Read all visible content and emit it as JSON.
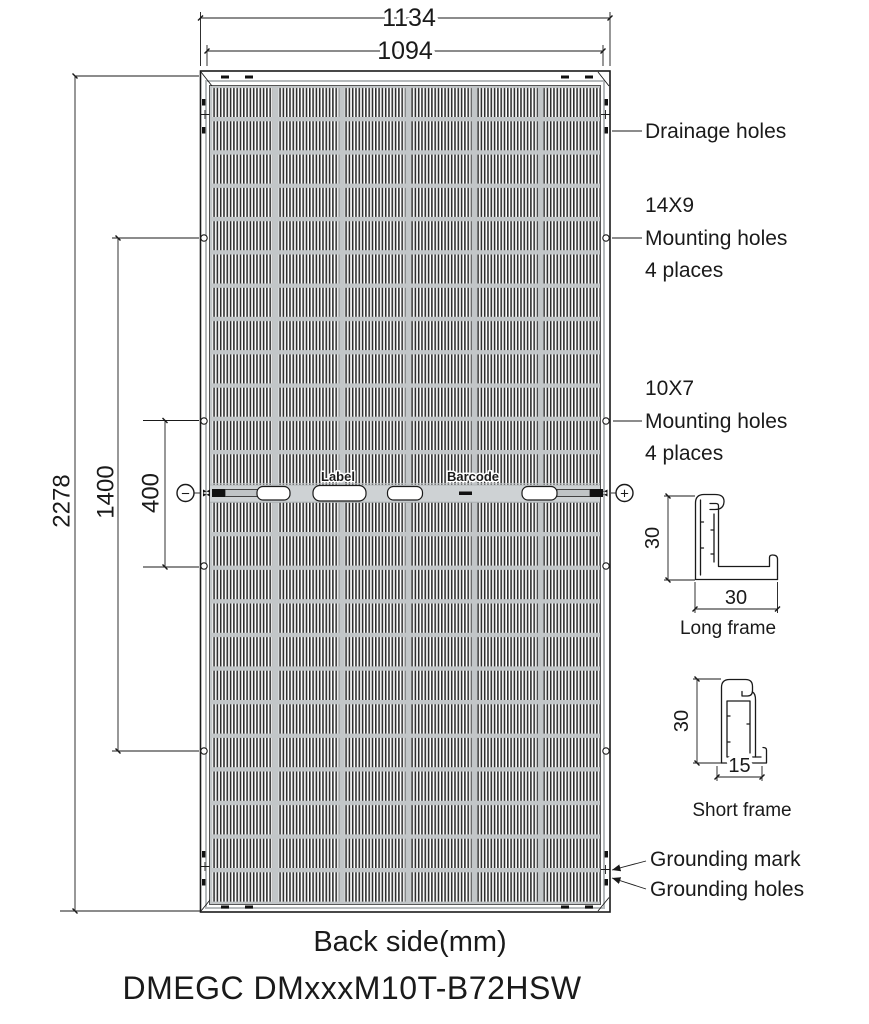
{
  "drawing": {
    "footer_view_label": "Back side(mm)",
    "model_number": "DMEGC DMxxxM10T-B72HSW"
  },
  "dimensions": {
    "overall_width_mm": "1134",
    "glass_width_mm": "1094",
    "overall_height_mm": "2278",
    "mounting_span_outer_mm": "1400",
    "mounting_span_inner_mm": "400"
  },
  "callouts": {
    "drainage": "Drainage holes",
    "mounting_14x9": {
      "size": "14X9",
      "name": "Mounting holes",
      "places": "4 places"
    },
    "mounting_10x7": {
      "size": "10X7",
      "name": "Mounting holes",
      "places": "4 places"
    },
    "grounding_mark": "Grounding mark",
    "grounding_holes": "Grounding holes"
  },
  "junction_area": {
    "label": "Label",
    "barcode": "Barcode",
    "negative_terminal": "−",
    "positive_terminal": "+"
  },
  "frame_profiles": {
    "long": {
      "label": "Long frame",
      "height_mm": "30",
      "width_mm": "30"
    },
    "short": {
      "label": "Short frame",
      "height_mm": "30",
      "width_mm": "15"
    }
  },
  "colors": {
    "line": "#1a1a1a",
    "grid_gray": "#c2c6c8",
    "band_gray": "#ced2d4"
  }
}
